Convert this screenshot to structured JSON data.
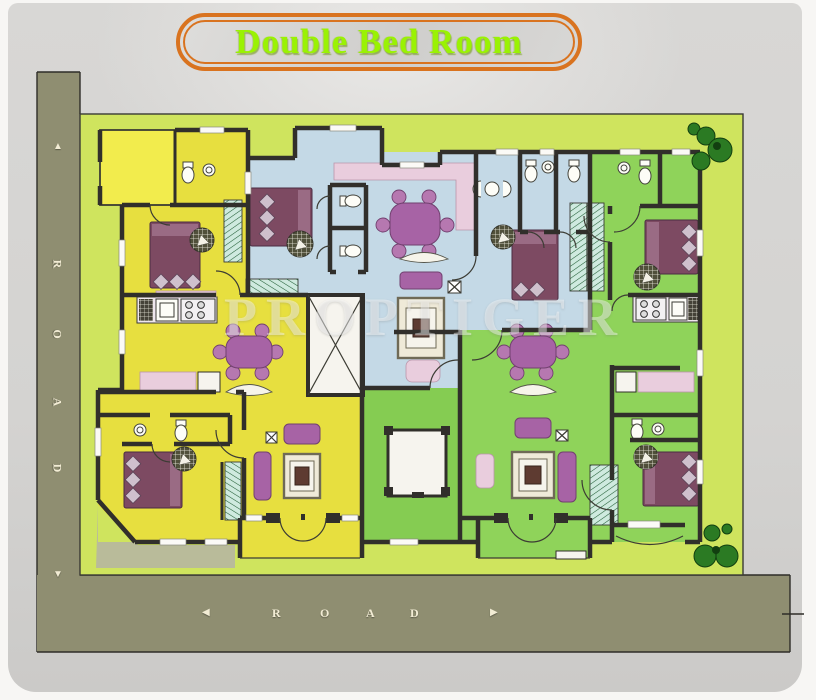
{
  "title": {
    "text": "Double Bed Room"
  },
  "watermark": {
    "text": "PROPTIGER"
  },
  "roads": {
    "left": {
      "letters": [
        "R",
        "O",
        "A",
        "D"
      ],
      "arrow_up": "▲",
      "arrow_down": "▼"
    },
    "bottom": {
      "letters": [
        "R",
        "O",
        "A",
        "D"
      ],
      "arrow_left": "◀",
      "arrow_right": "▶"
    }
  },
  "colors": {
    "panel": "#d7d6d4",
    "road": "#8f8e71",
    "lawn": "#cfe45e",
    "unit_yellow": "#e7df3f",
    "unit_blue": "#c4d9e6",
    "unit_green": "#8fd35a",
    "courtyard_green": "#85cc52",
    "terrace_yellow": "#f2ec4d",
    "wall": "#312f2b",
    "bed": "#7d4a62",
    "sofa": "#a763a5",
    "pink": "#e9cddd",
    "tree": "#2b7a23",
    "title_text": "#9af203",
    "title_border": "#d9731f",
    "letter_cream": "#f2ecd4"
  }
}
